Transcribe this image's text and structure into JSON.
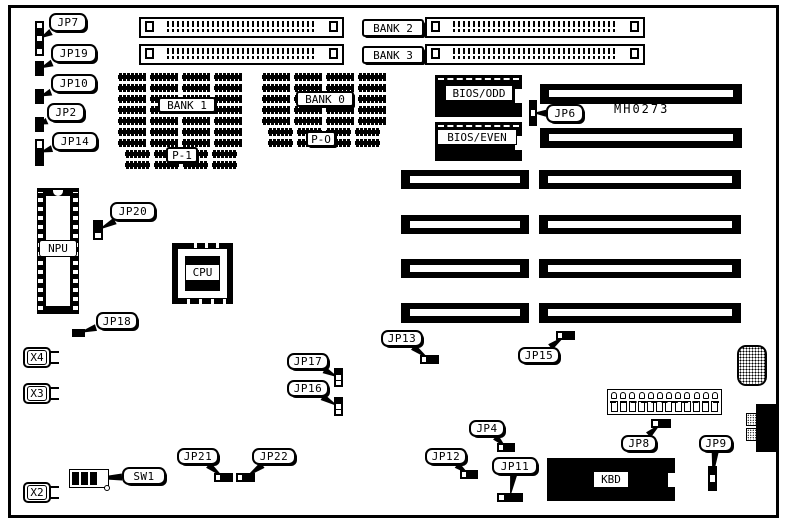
{
  "figure": {
    "part_number": "MH0273"
  },
  "colors": {
    "ink": "#000000",
    "paper": "#ffffff"
  },
  "components": {
    "npu_label": "NPU",
    "cpu_label": "CPU",
    "kbd_label": "KBD",
    "power_pins": 12,
    "crystals": [
      {
        "text": "X4",
        "box": [
          23,
          347,
          28,
          21
        ]
      },
      {
        "text": "X3",
        "box": [
          23,
          383,
          28,
          21
        ]
      },
      {
        "text": "X2",
        "box": [
          23,
          482,
          28,
          21
        ]
      }
    ]
  },
  "simm_sockets": [
    {
      "name": "simm-socket-bank2-left",
      "box": [
        139,
        17,
        205,
        21
      ]
    },
    {
      "name": "simm-socket-bank2-right",
      "box": [
        425,
        17,
        220,
        21
      ]
    },
    {
      "name": "simm-socket-bank3-left",
      "box": [
        139,
        44,
        205,
        21
      ]
    },
    {
      "name": "simm-socket-bank3-right",
      "box": [
        425,
        44,
        220,
        21
      ]
    }
  ],
  "boxed_labels": [
    {
      "id": "bank2",
      "text": "BANK 2",
      "box": [
        362,
        19,
        62,
        18
      ]
    },
    {
      "id": "bank3",
      "text": "BANK 3",
      "box": [
        362,
        46,
        62,
        18
      ]
    },
    {
      "id": "bank1",
      "text": "BANK 1",
      "box": [
        158,
        97,
        58,
        16
      ]
    },
    {
      "id": "bank0",
      "text": "BANK 0",
      "box": [
        296,
        91,
        58,
        16
      ]
    },
    {
      "id": "p1",
      "text": "P-1",
      "box": [
        166,
        147,
        32,
        16
      ]
    },
    {
      "id": "p0",
      "text": "P-O",
      "box": [
        306,
        131,
        30,
        16
      ]
    }
  ],
  "ram_blocks": [
    {
      "name": "ram-array-bank1",
      "x": 118,
      "y": 73,
      "cols": 4,
      "rows": 7,
      "cw": 28,
      "ch": 8,
      "gx": 4,
      "gy": 3
    },
    {
      "name": "ram-array-p1",
      "x": 125,
      "y": 150,
      "cols": 4,
      "rows": 2,
      "cw": 25,
      "ch": 8,
      "gx": 4,
      "gy": 3
    },
    {
      "name": "ram-array-bank0",
      "x": 262,
      "y": 73,
      "cols": 4,
      "rows": 5,
      "cw": 28,
      "ch": 8,
      "gx": 4,
      "gy": 3
    },
    {
      "name": "ram-array-p0",
      "x": 268,
      "y": 128,
      "cols": 4,
      "rows": 2,
      "cw": 25,
      "ch": 8,
      "gx": 4,
      "gy": 3
    }
  ],
  "isa_segments": [
    {
      "name": "isa-slot-1",
      "box": [
        540,
        84,
        202,
        20
      ]
    },
    {
      "name": "isa-slot-2",
      "box": [
        540,
        128,
        202,
        20
      ]
    },
    {
      "name": "isa-slot-3-left",
      "box": [
        401,
        170,
        128,
        19
      ]
    },
    {
      "name": "isa-slot-3-right",
      "box": [
        539,
        170,
        202,
        19
      ]
    },
    {
      "name": "isa-slot-4-left",
      "box": [
        401,
        215,
        128,
        19
      ]
    },
    {
      "name": "isa-slot-4-right",
      "box": [
        539,
        215,
        202,
        19
      ]
    },
    {
      "name": "isa-slot-5-left",
      "box": [
        401,
        259,
        128,
        19
      ]
    },
    {
      "name": "isa-slot-5-right",
      "box": [
        539,
        259,
        202,
        19
      ]
    },
    {
      "name": "isa-slot-6-left",
      "box": [
        401,
        303,
        128,
        20
      ]
    },
    {
      "name": "isa-slot-6-right",
      "box": [
        539,
        303,
        202,
        20
      ]
    }
  ],
  "bios_chips": [
    {
      "text": "BIOS/ODD",
      "box": [
        435,
        75,
        87,
        42
      ],
      "label_box": [
        10,
        10,
        68,
        16
      ]
    },
    {
      "text": "BIOS/EVEN",
      "box": [
        435,
        122,
        87,
        39
      ],
      "label_box": [
        2,
        7,
        80,
        16
      ]
    }
  ],
  "callouts": [
    {
      "label": "JP7",
      "box": [
        49,
        13,
        38,
        19
      ],
      "jumper": {
        "box": [
          35,
          21,
          9,
          35
        ],
        "dir": "v",
        "cells": "wbwbw"
      }
    },
    {
      "label": "JP19",
      "box": [
        51,
        44,
        46,
        19
      ],
      "jumper": {
        "box": [
          35,
          61,
          9,
          15
        ],
        "dir": "v",
        "cells": "bb"
      }
    },
    {
      "label": "JP10",
      "box": [
        51,
        74,
        46,
        19
      ],
      "jumper": {
        "box": [
          35,
          89,
          9,
          15
        ],
        "dir": "v",
        "cells": "bb"
      }
    },
    {
      "label": "JP2",
      "box": [
        47,
        103,
        38,
        19
      ],
      "jumper": {
        "box": [
          35,
          117,
          9,
          15
        ],
        "dir": "v",
        "cells": "bb"
      }
    },
    {
      "label": "JP14",
      "box": [
        52,
        132,
        46,
        19
      ],
      "jumper": {
        "box": [
          35,
          139,
          9,
          27
        ],
        "dir": "v",
        "cells": "wbb"
      }
    },
    {
      "label": "JP20",
      "box": [
        110,
        202,
        46,
        19
      ],
      "jumper": {
        "box": [
          93,
          220,
          10,
          20
        ],
        "dir": "v",
        "cells": "bbw"
      }
    },
    {
      "label": "JP18",
      "box": [
        96,
        312,
        42,
        18
      ],
      "jumper": {
        "box": [
          72,
          329,
          13,
          8
        ],
        "dir": "h",
        "cells": "bb"
      }
    },
    {
      "label": "JP6",
      "box": [
        546,
        104,
        38,
        19
      ],
      "jumper": {
        "box": [
          529,
          100,
          8,
          26
        ],
        "dir": "v",
        "cells": "bwb"
      }
    },
    {
      "label": "JP13",
      "box": [
        381,
        330,
        42,
        17
      ],
      "jumper": {
        "box": [
          420,
          355,
          19,
          9
        ],
        "dir": "h",
        "cells": "wbb"
      }
    },
    {
      "label": "JP15",
      "box": [
        518,
        347,
        42,
        17
      ],
      "jumper": {
        "box": [
          556,
          331,
          19,
          9
        ],
        "dir": "h",
        "cells": "wbb"
      }
    },
    {
      "label": "JP17",
      "box": [
        287,
        353,
        42,
        17
      ],
      "jumper": {
        "box": [
          334,
          368,
          9,
          19
        ],
        "dir": "v",
        "cells": "bww"
      }
    },
    {
      "label": "JP16",
      "box": [
        287,
        380,
        42,
        17
      ],
      "jumper": {
        "box": [
          334,
          397,
          9,
          19
        ],
        "dir": "v",
        "cells": "bww"
      }
    },
    {
      "label": "JP21",
      "box": [
        177,
        448,
        42,
        17
      ],
      "jumper": {
        "box": [
          214,
          473,
          19,
          9
        ],
        "dir": "h",
        "cells": "wbb"
      }
    },
    {
      "label": "JP22",
      "box": [
        252,
        448,
        44,
        17
      ],
      "jumper": {
        "box": [
          236,
          473,
          19,
          9
        ],
        "dir": "h",
        "cells": "wbb"
      }
    },
    {
      "label": "JP12",
      "box": [
        425,
        448,
        42,
        17
      ],
      "jumper": {
        "box": [
          460,
          470,
          18,
          9
        ],
        "dir": "h",
        "cells": "wbb"
      }
    },
    {
      "label": "JP4",
      "box": [
        469,
        420,
        36,
        17
      ],
      "jumper": {
        "box": [
          497,
          443,
          18,
          9
        ],
        "dir": "h",
        "cells": "wbb"
      }
    },
    {
      "label": "JP11",
      "box": [
        492,
        457,
        46,
        18
      ],
      "jumper": {
        "box": [
          497,
          493,
          26,
          9
        ],
        "dir": "h",
        "cells": "wbbb"
      }
    },
    {
      "label": "JP8",
      "box": [
        621,
        435,
        36,
        17
      ],
      "jumper": {
        "box": [
          651,
          419,
          20,
          9
        ],
        "dir": "h",
        "cells": "wbb"
      }
    },
    {
      "label": "JP9",
      "box": [
        699,
        435,
        34,
        17
      ],
      "jumper": {
        "box": [
          708,
          466,
          9,
          25
        ],
        "dir": "v",
        "cells": "bwb"
      }
    },
    {
      "label": "SW1",
      "box": [
        122,
        467,
        44,
        18
      ],
      "jumper": {
        "box": [
          69,
          469,
          40,
          19
        ],
        "dir": "dip",
        "cells": "bbbw"
      }
    }
  ]
}
